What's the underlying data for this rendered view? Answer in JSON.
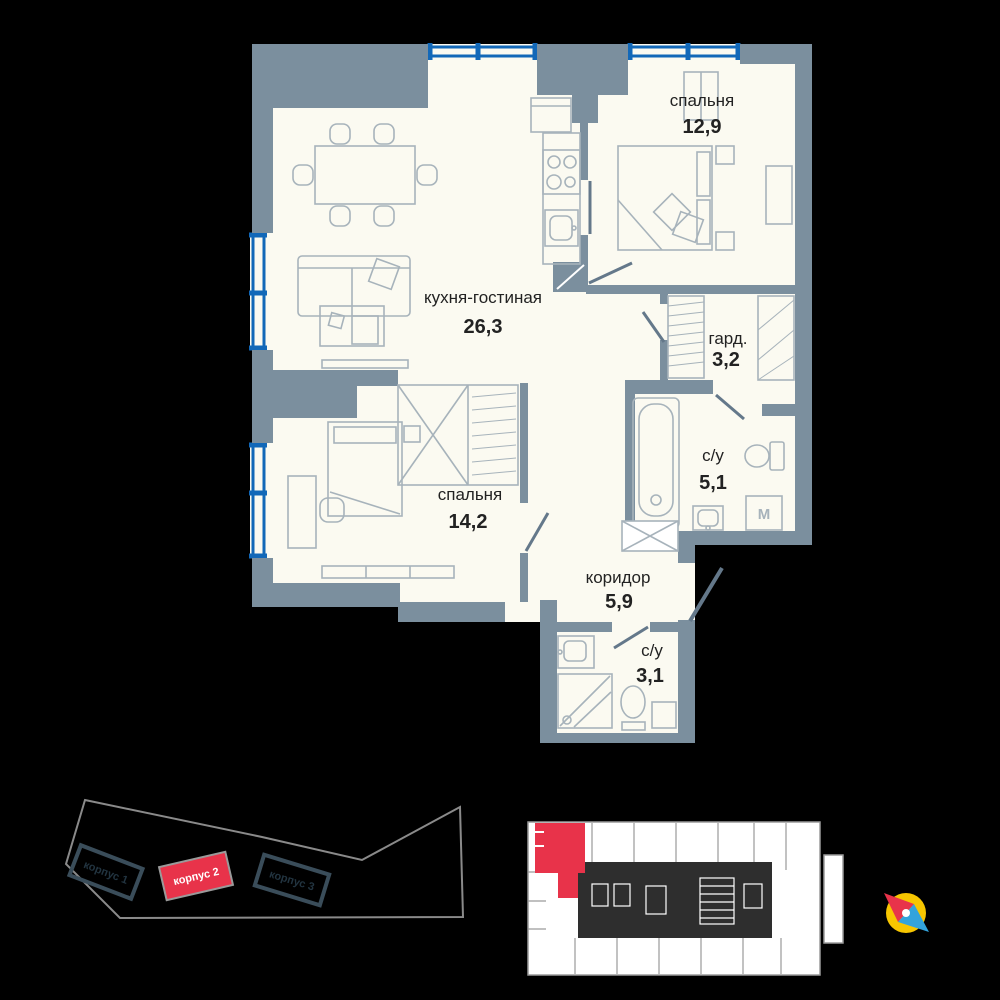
{
  "colors": {
    "wall": "#7b8f9e",
    "wall-dark": "#64788a",
    "window": "#1268b8",
    "floor": "#fbfaf1",
    "furniture": "#a7b3bb",
    "label": "#222222",
    "accent": "#e8334a",
    "site-outline": "#8a8a8a",
    "building": "#3a4d5a",
    "building-label": "#223440",
    "keyplan-line": "#9a9a9a",
    "core": "#2e2e2e",
    "compass-yellow": "#f7c600",
    "compass-blue": "#33a3dc"
  },
  "floor_plan": {
    "rooms": [
      {
        "name": "спальня",
        "area": "12,9"
      },
      {
        "name": "кухня-гостиная",
        "area": "26,3"
      },
      {
        "name": "гард.",
        "area": "3,2"
      },
      {
        "name": "с/у",
        "area": "5,1"
      },
      {
        "name": "спальня",
        "area": "14,2"
      },
      {
        "name": "коридор",
        "area": "5,9"
      },
      {
        "name": "с/у",
        "area": "3,1"
      }
    ],
    "washer_label": "M"
  },
  "site_plan": {
    "buildings": [
      {
        "label": "корпус 1",
        "highlighted": false
      },
      {
        "label": "корпус 2",
        "highlighted": true
      },
      {
        "label": "корпус 3",
        "highlighted": false
      }
    ]
  }
}
